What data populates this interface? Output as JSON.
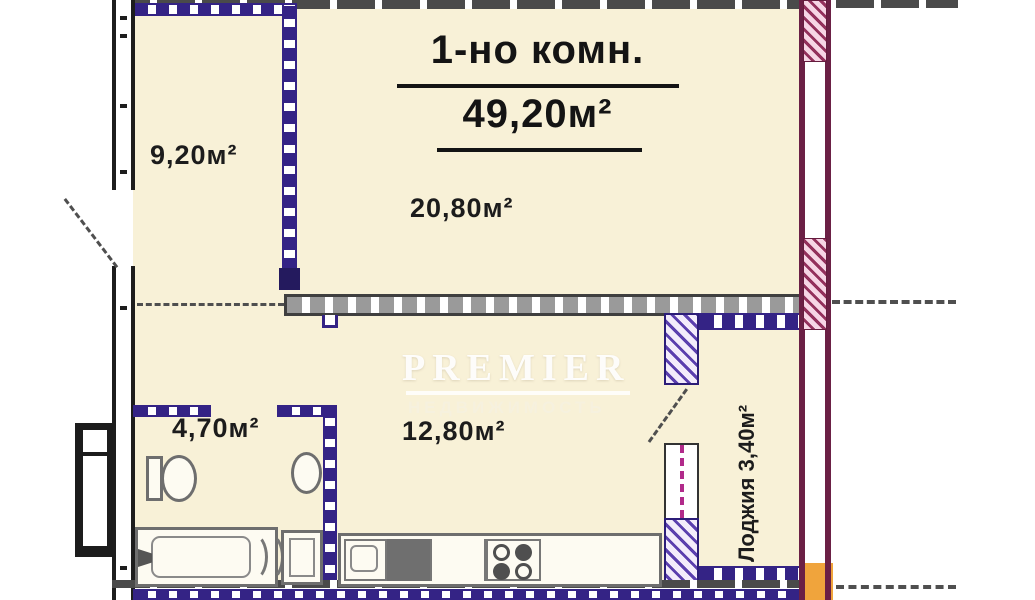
{
  "plan": {
    "title": {
      "name": "1-но комн.",
      "area": "49,20м²"
    },
    "rooms": [
      {
        "id": "hall",
        "label": "9,20м²"
      },
      {
        "id": "living",
        "label": "20,80м²"
      },
      {
        "id": "bathroom",
        "label": "4,70м²"
      },
      {
        "id": "kitchen",
        "label": "12,80м²"
      },
      {
        "id": "loggia",
        "label": "Лоджия 3,40м²"
      }
    ],
    "watermark": {
      "brand": "PREMIER",
      "subtitle": "НЕДВИЖИМОСТЬ"
    },
    "colors": {
      "interior_fill": "#f8f1d7",
      "wall_purple": "#342385",
      "wall_gray": "#4a4a4a",
      "wall_maroon": "#6b2045",
      "hatch_purple": "#5b3fae",
      "accent_orange": "#f0a43c",
      "window_magenta": "#b12a8a",
      "text": "#1c1c1c"
    }
  }
}
